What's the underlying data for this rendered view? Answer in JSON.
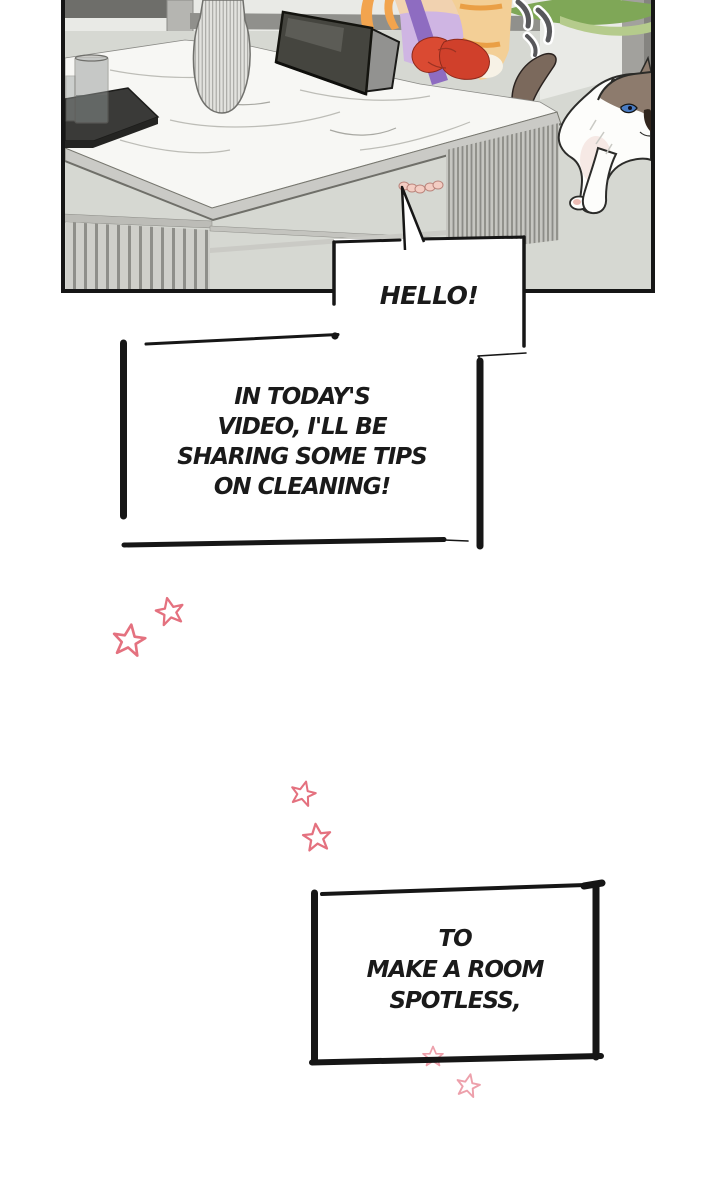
{
  "comic": {
    "speech": {
      "hello": {
        "text": "HELLO!"
      },
      "intro": {
        "line1": "IN TODAY'S",
        "line2": "VIDEO, I'LL BE",
        "line3": "SHARING SOME TIPS",
        "line4": "ON CLEANING!"
      },
      "closing": {
        "line1": "TO",
        "line2": "MAKE A ROOM",
        "line3": "SPOTLESS,"
      }
    },
    "scene": {
      "objects": [
        "marble-table",
        "table-slat-legs",
        "serving-tray",
        "drinking-glass",
        "ribbed-vase",
        "tablet-on-stand",
        "person-with-rubber-gloves",
        "ragdoll-cat",
        "cat-tail",
        "plant-leaves",
        "motion-lines",
        "window-frame",
        "bare-feet"
      ]
    },
    "decorations": {
      "star_count": 6,
      "star_color": "#e4717f"
    },
    "colors": {
      "ink": "#161616",
      "wall": "#e9eae6",
      "floor": "#d6d8d2",
      "marble": "#f7f7f4",
      "glove_red": "#d84a32",
      "apron_lavender": "#cfb5e3",
      "strap_purple": "#8e6cc1",
      "cardigan_orange": "#f3cf96",
      "cat_brown": "#8d7b6d",
      "cat_eye_blue": "#4a7cc2",
      "leaf_green": "#7fa757",
      "tray_black": "#3a3a38"
    }
  }
}
